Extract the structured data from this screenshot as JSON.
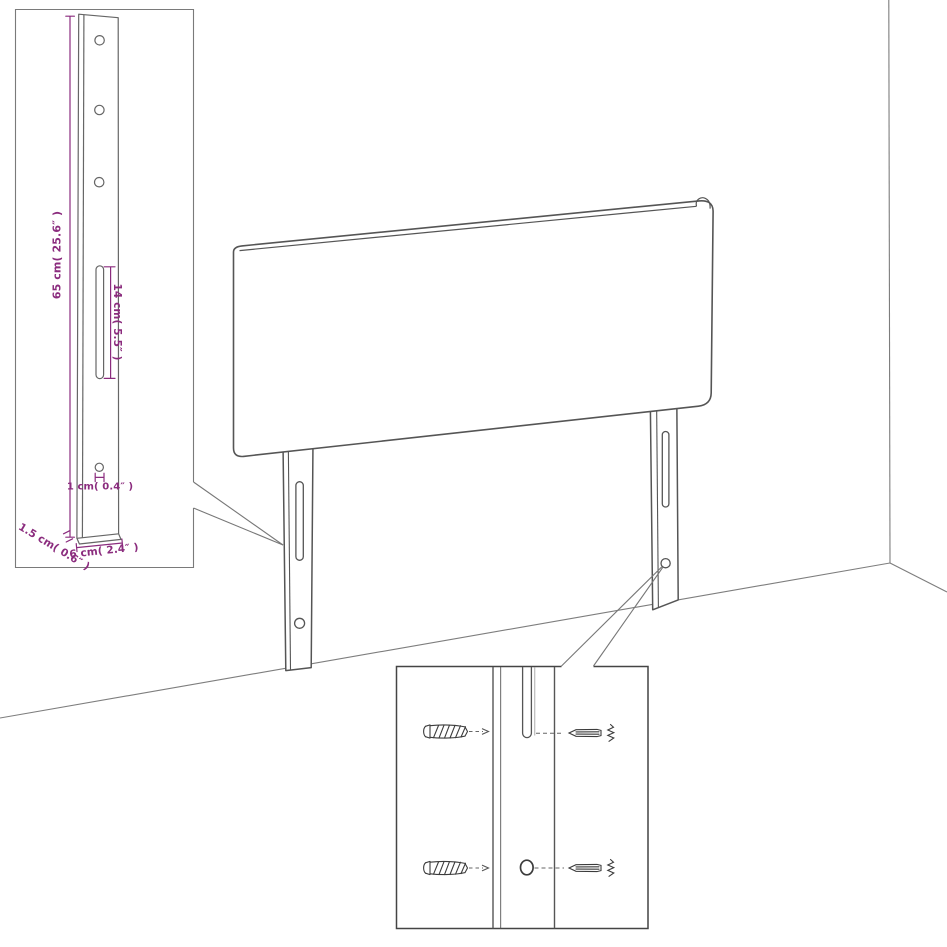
{
  "diagram": {
    "type": "furniture-assembly-diagram",
    "subject": "headboard-with-two-mounting-legs-in-room-corner"
  },
  "colors": {
    "accent_dimension": "#8b2c7e",
    "line_gray": "#555555",
    "background": "#ffffff"
  },
  "leg_detail_callout": {
    "height_label": "65 cm( 25.6″ )",
    "slot_label": "14 cm( 5.5″ )",
    "hole_label": "1 cm( 0.4″ )",
    "width_label": "6 cm( 2.4″ )",
    "thickness_label": "1.5 cm( 0.6″ )",
    "hole_count": 3,
    "slot_count": 1
  },
  "hardware_callout": {
    "rows": 2,
    "left_item": "screw",
    "right_item": "wall-plug"
  }
}
